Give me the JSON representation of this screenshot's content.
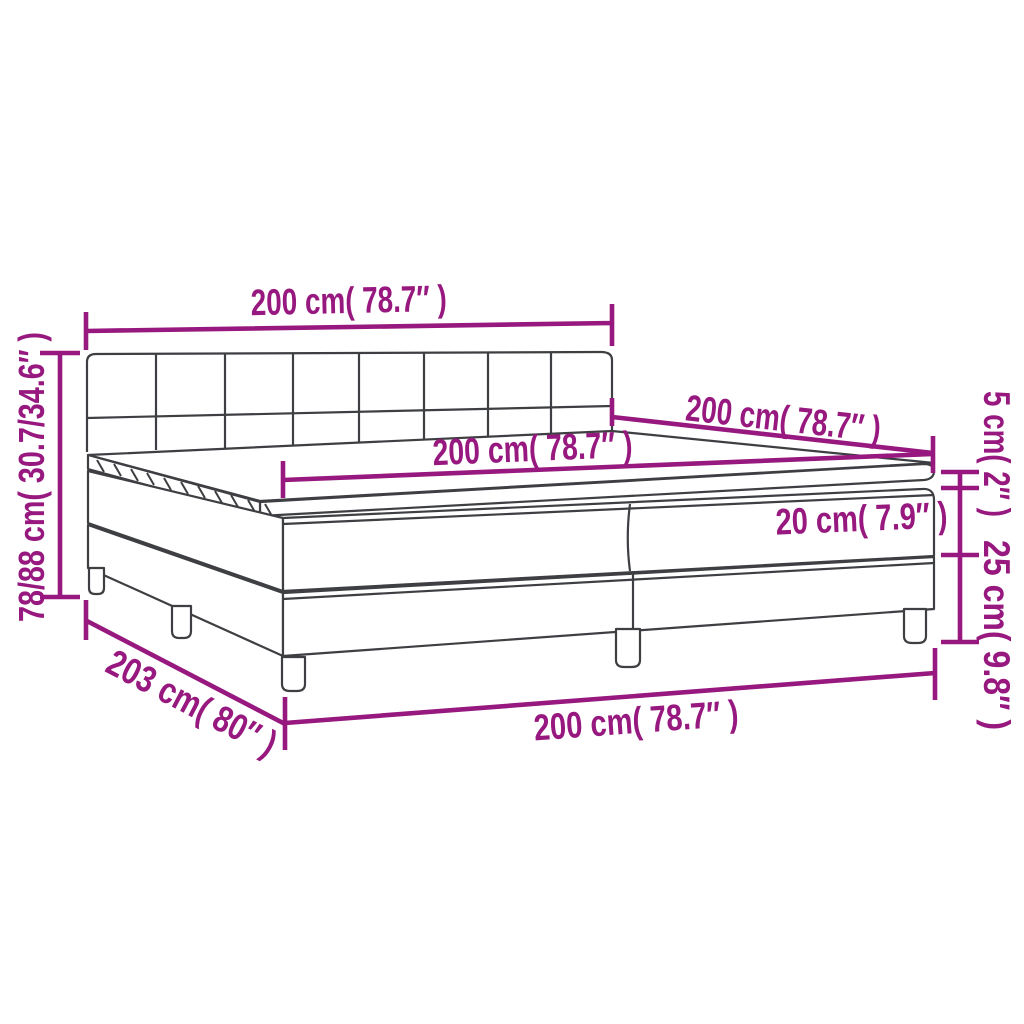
{
  "diagram": {
    "type": "product-dimension-diagram",
    "product": "box-spring-bed-with-tufted-headboard-mattress-and-topper",
    "accent_color": "#97187E",
    "outline_color": "#3E3F42",
    "background_color": "#FFFFFF",
    "labels": {
      "headboard_width_top": "200 cm( 78.7″ )",
      "total_height_left": "78/88 cm( 30.7/34.6″ )",
      "mattress_length_upper_right": "200 cm( 78.7″ )",
      "mattress_width_middle": "200 cm( 78.7″ )",
      "topper_height_right": "5 cm( 2″ )",
      "mattress_height_inner": "20 cm( 7.9″ )",
      "base_height_right": "25 cm( 9.8″ )",
      "bed_length_lower_left": "203 cm( 80″ )",
      "bed_width_bottom": "200 cm( 78.7″ )"
    }
  }
}
